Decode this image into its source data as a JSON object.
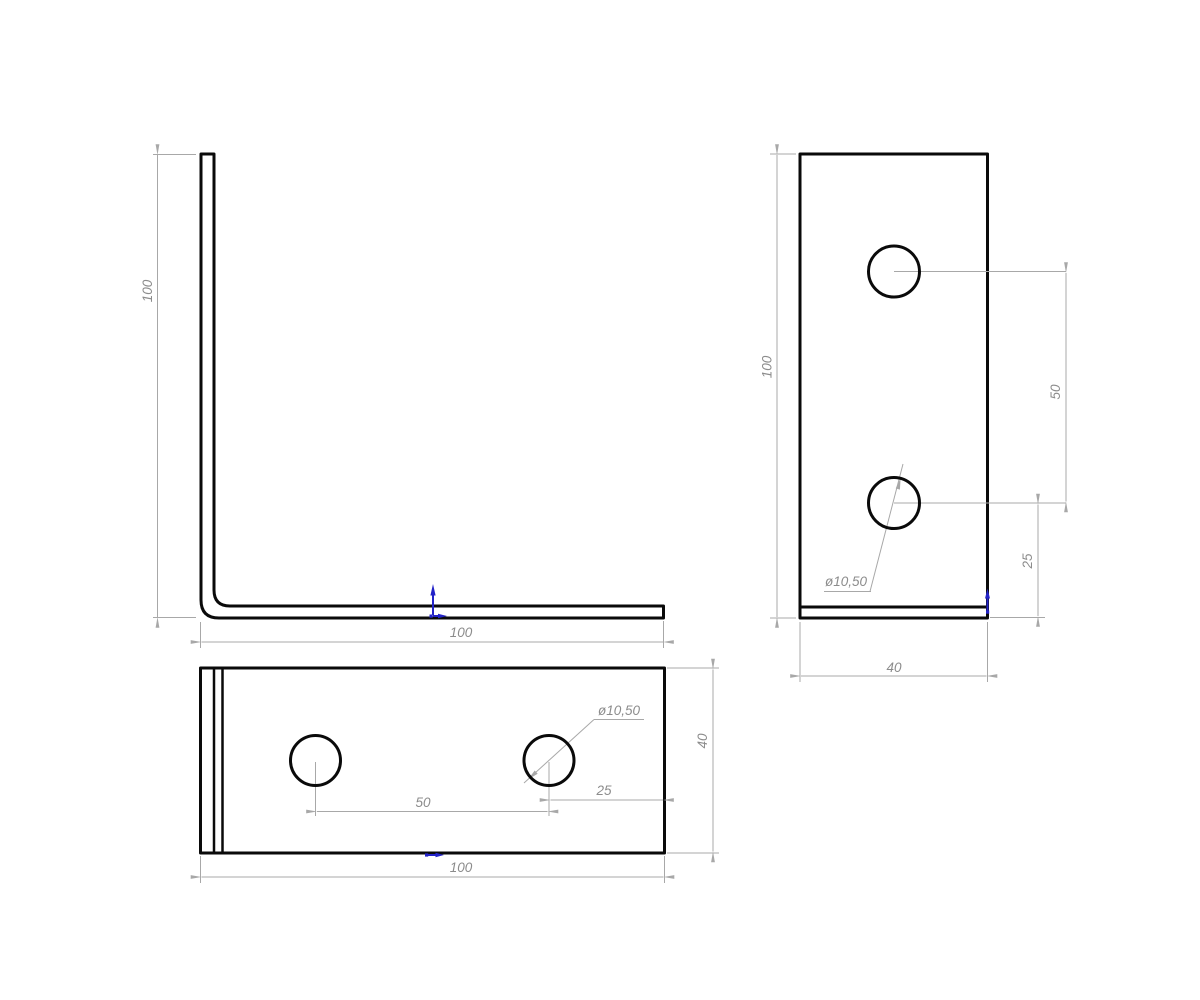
{
  "drawing": {
    "kind": "CAD technical drawing, three orthographic views of an L-shaped corner bracket with two round holes",
    "units": "mm",
    "views": {
      "side": {
        "title": "side profile (L-shape)",
        "labels": {
          "height": "100",
          "width": "100"
        }
      },
      "front": {
        "title": "front face of vertical leg",
        "labels": {
          "height": "100",
          "hole_spacing": "50",
          "hole_to_edge": "25",
          "width": "40",
          "hole_diameter": "ø10,50"
        }
      },
      "plan": {
        "title": "plan of horizontal leg",
        "labels": {
          "width": "100",
          "hole_spacing": "50",
          "hole_to_edge": "25",
          "depth": "40",
          "hole_diameter": "ø10,50"
        }
      }
    },
    "dimensions_mm": {
      "leg_length": 100,
      "leg_width": 40,
      "hole_diameter": 10.5,
      "hole_center_spacing": 50,
      "hole_center_to_end": 25
    },
    "colors": {
      "outline": "#0a0a0a",
      "dimension_line": "#a8a8a8",
      "dimension_text": "#8c8c8c",
      "origin_marker": "#2323c8",
      "background": "#ffffff"
    }
  }
}
